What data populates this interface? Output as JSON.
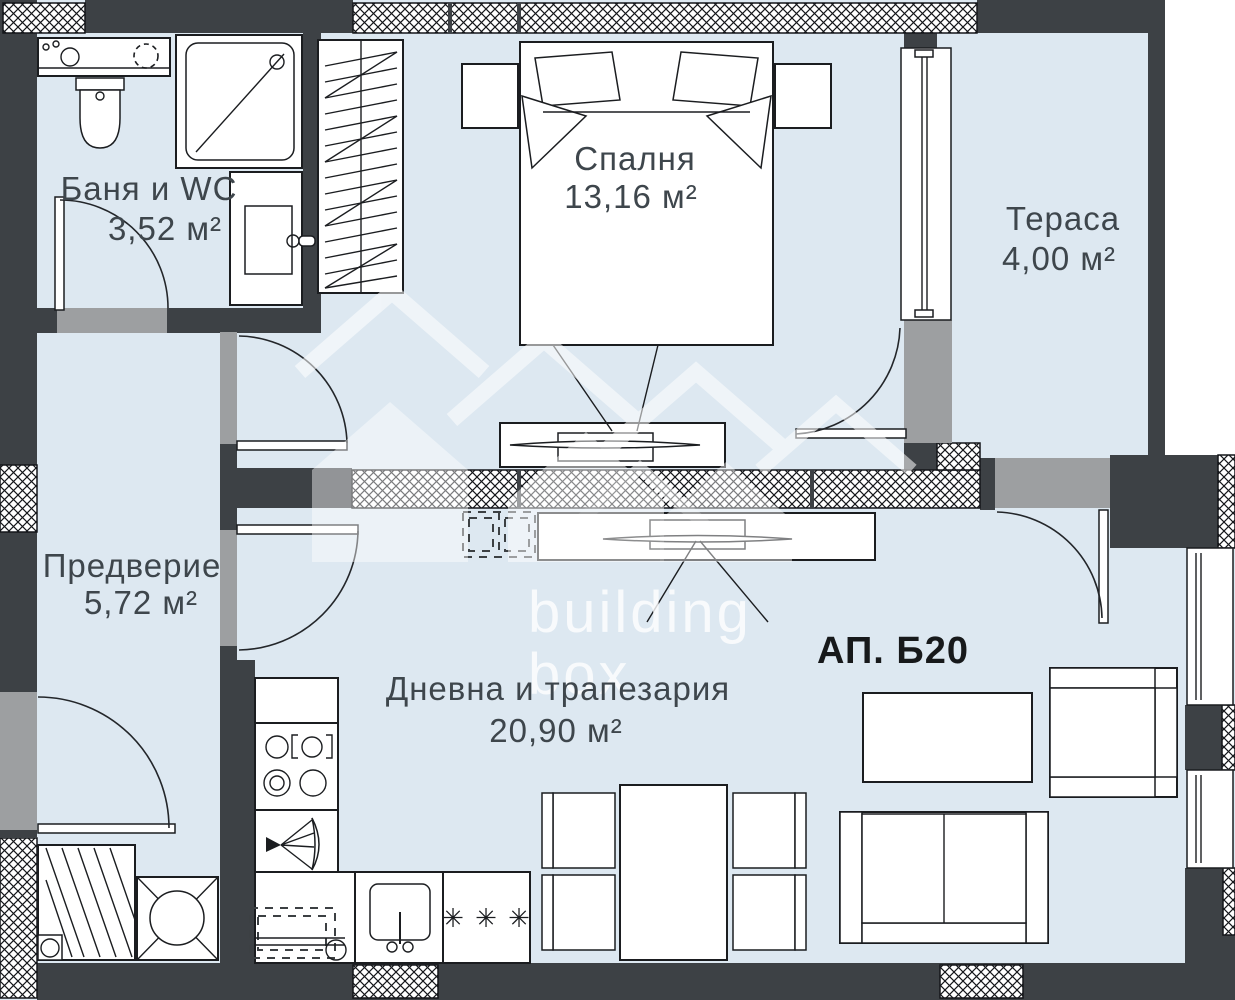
{
  "plan": {
    "apartment_label": "АП. Б20",
    "watermark": {
      "line1": "building",
      "line2": "box"
    },
    "rooms": {
      "bathroom": {
        "name": "Баня и WC",
        "area": "3,52 м²"
      },
      "bedroom": {
        "name": "Спалня",
        "area": "13,16 м²"
      },
      "terrace": {
        "name": "Тераса",
        "area": "4,00 м²"
      },
      "hall": {
        "name": "Предверие",
        "area": "5,72 м²"
      },
      "living": {
        "name": "Дневна и трапезария",
        "area": "20,90 м²"
      }
    },
    "kitchen": {
      "dishwasher_marks": "✳ ✳ ✳"
    },
    "colors": {
      "floor": "#dde8f1",
      "wall_dark": "#3d4145",
      "threshold_gray": "#9d9fa1",
      "line": "#1b1d20",
      "label_text": "#3e464c",
      "apartment_text": "#17191b",
      "watermark": "#ffffff"
    }
  }
}
